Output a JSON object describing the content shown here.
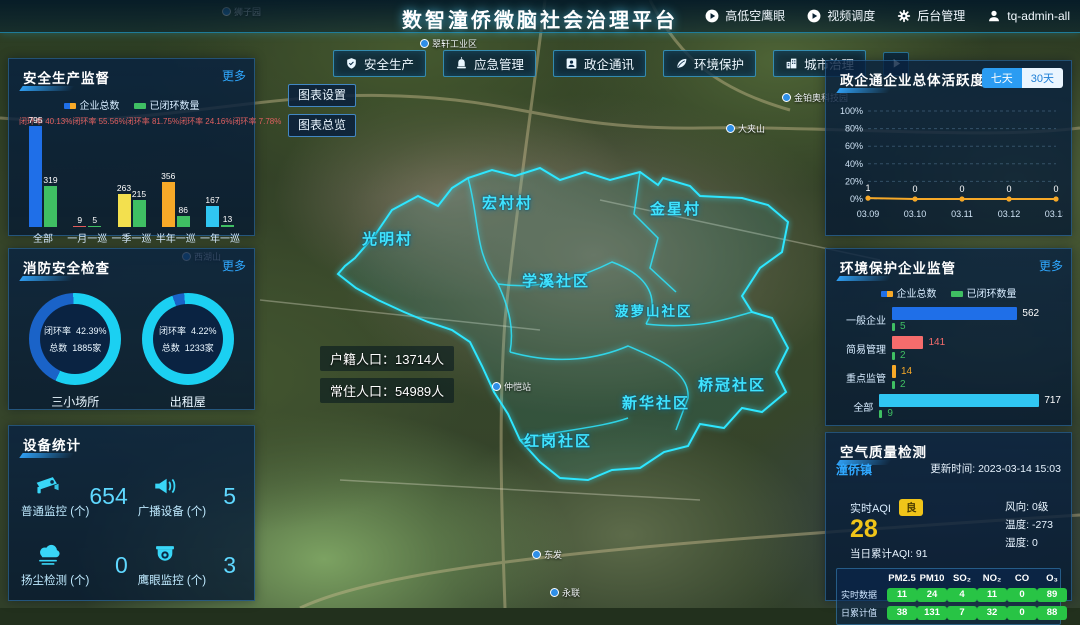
{
  "header": {
    "title": "数智潼侨微脑社会治理平台",
    "actions": [
      {
        "label": "高低空鹰眼",
        "icon": "play-circle"
      },
      {
        "label": "视频调度",
        "icon": "play-circle"
      },
      {
        "label": "后台管理",
        "icon": "gear"
      },
      {
        "label": "tq-admin-all",
        "icon": "user"
      }
    ]
  },
  "tabs": [
    {
      "label": "安全生产",
      "icon": "shield"
    },
    {
      "label": "应急管理",
      "icon": "siren"
    },
    {
      "label": "政企通讯",
      "icon": "contact"
    },
    {
      "label": "环境保护",
      "icon": "leaf"
    },
    {
      "label": "城市治理",
      "icon": "city"
    }
  ],
  "map_tools": {
    "chart_settings": "图表设置",
    "chart_overview": "图表总览"
  },
  "map": {
    "districts": [
      "宏村村",
      "金星村",
      "光明村",
      "学溪社区",
      "菠萝山社区",
      "新华社区",
      "桥冠社区",
      "红岗社区"
    ],
    "pois": [
      "狮子园",
      "翠轩工业区",
      "金铂奥科技园",
      "大夹山",
      "西湖山",
      "仲恺站",
      "东发",
      "永联"
    ],
    "population": {
      "line1_label": "户籍人口：",
      "line1_value": "13714人",
      "line2_label": "常住人口：",
      "line2_value": "54989人"
    }
  },
  "panels": {
    "safety": {
      "title": "安全生产监督",
      "more": "更多",
      "legend": [
        "企业总数",
        "已闭环数量"
      ],
      "rate_label": "闭环率"
    },
    "fire": {
      "title": "消防安全检查",
      "more": "更多"
    },
    "devices": {
      "title": "设备统计",
      "items": [
        {
          "label": "普通监控 (个)",
          "value": "654",
          "icon": "cctv-camera"
        },
        {
          "label": "广播设备 (个)",
          "value": "5",
          "icon": "megaphone"
        },
        {
          "label": "扬尘检测 (个)",
          "value": "0",
          "icon": "dust-cloud"
        },
        {
          "label": "鹰眼监控 (个)",
          "value": "3",
          "icon": "dome-camera"
        }
      ]
    },
    "activity": {
      "title": "政企通企业总体活跃度",
      "toggle_seven": "七天",
      "toggle_thirty": "30天"
    },
    "env": {
      "title": "环境保护企业监管",
      "more": "更多",
      "legend": [
        "企业总数",
        "已闭环数量"
      ]
    },
    "air": {
      "title": "空气质量检测",
      "town": "潼侨镇",
      "updated": "更新时间: 2023-03-14 15:03",
      "realtime_label": "实时AQI",
      "grade": "良",
      "aqi": "28",
      "daily": "当日累计AQI:  91",
      "wind": "风向:  0级",
      "temp": "温度:  -273",
      "humidity": "湿度:  0",
      "table": {
        "headers": [
          "PM2.5",
          "PM10",
          "SO₂",
          "NO₂",
          "CO",
          "O₃"
        ],
        "rows": [
          {
            "label": "实时数据",
            "values": [
              11,
              24,
              4,
              11,
              0,
              89
            ]
          },
          {
            "label": "日累计值",
            "values": [
              38,
              131,
              7,
              32,
              0,
              88
            ]
          }
        ]
      }
    }
  },
  "chart_data": [
    {
      "id": "safety_bars",
      "type": "bar",
      "title": "安全生产监督",
      "legend": [
        "企业总数",
        "已闭环数量"
      ],
      "categories": [
        "全部",
        "一月一巡",
        "一季一巡",
        "半年一巡",
        "一年一巡"
      ],
      "series": [
        {
          "name": "企业总数",
          "values": [
            795,
            9,
            263,
            356,
            167
          ],
          "colors": [
            "#1f6fe8",
            "#e05b5b",
            "#f3e04e",
            "#f7a928",
            "#30c6f2"
          ]
        },
        {
          "name": "已闭环数量",
          "values": [
            319,
            5,
            215,
            86,
            13
          ],
          "color": "#3fbf63"
        }
      ],
      "closure_rates": [
        "40.13%",
        "55.56%",
        "81.75%",
        "24.16%",
        "7.78%"
      ],
      "ylim": [
        0,
        795
      ]
    },
    {
      "id": "fire_donuts",
      "type": "pie",
      "title": "消防安全检查",
      "donuts": [
        {
          "label": "三小场所",
          "rate_label": "闭环率",
          "rate": "42.39%",
          "total_label": "总数",
          "total": "1885家",
          "pct": 42.39
        },
        {
          "label": "出租屋",
          "rate_label": "闭环率",
          "rate": "4.22%",
          "total_label": "总数",
          "total": "1233家",
          "pct": 4.22
        }
      ],
      "colors": {
        "closed": "#1a63c8",
        "remain": "#1bd0f2"
      }
    },
    {
      "id": "activity_line",
      "type": "line",
      "title": "政企通企业总体活跃度",
      "x": [
        "03.09",
        "03.10",
        "03.11",
        "03.12",
        "03.13"
      ],
      "values": [
        1,
        0,
        0,
        0,
        0
      ],
      "yticks": [
        "100%",
        "80%",
        "60%",
        "40%",
        "20%",
        "0%"
      ],
      "ylim": [
        0,
        100
      ],
      "line_color": "#f7a928",
      "legend_position": "none",
      "grid": true
    },
    {
      "id": "env_bars",
      "type": "bar",
      "orientation": "horizontal",
      "title": "环境保护企业监管",
      "categories": [
        "一般企业",
        "简易管理",
        "重点监管",
        "全部"
      ],
      "series": [
        {
          "name": "企业总数",
          "values": [
            562,
            141,
            14,
            717
          ],
          "colors": [
            "#1f6fe8",
            "#f56c6c",
            "#f7a928",
            "#30c6f2"
          ]
        },
        {
          "name": "已闭环数量",
          "values": [
            5,
            2,
            2,
            9
          ],
          "color": "#3fbf63"
        }
      ],
      "xlim": [
        0,
        717
      ]
    }
  ]
}
